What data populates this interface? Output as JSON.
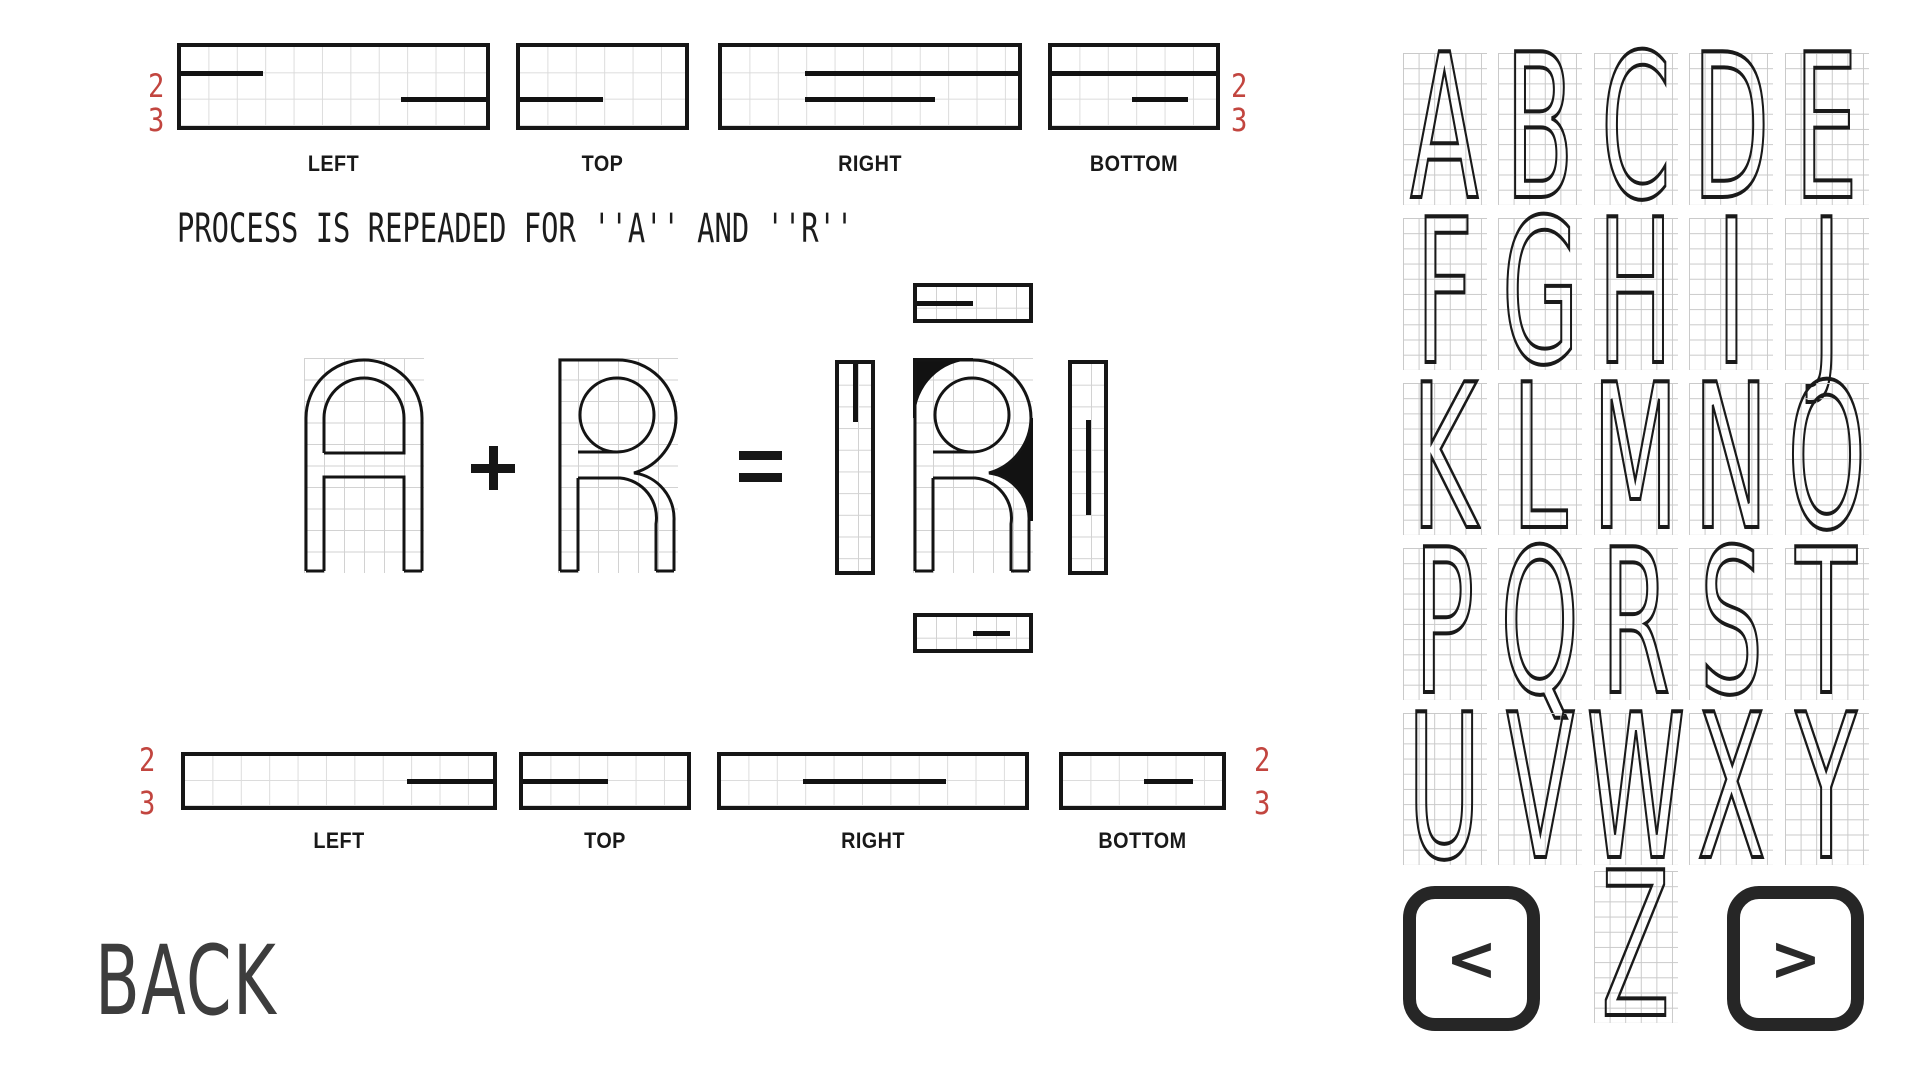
{
  "colors": {
    "ink": "#161616",
    "accent_red": "#c2453f",
    "grid_line": "#d2d2d2",
    "back_text": "#3d3d3d"
  },
  "caption": {
    "text": "PROCESS IS REPEADED FOR ''A'' AND ''R''"
  },
  "back_button": {
    "label": "BACK"
  },
  "equation": {
    "letter_a": "A",
    "letter_r": "R",
    "plus": "+",
    "equals": "=",
    "result_letter": "R"
  },
  "side_view_rows": {
    "top": {
      "id": "top",
      "top": 43,
      "height": 87,
      "rows": 3,
      "label_y": 151,
      "digits": {
        "values": [
          "2",
          "3"
        ],
        "left_x": 148,
        "right_x": 1231,
        "ys": [
          67,
          101
        ]
      },
      "boxes": [
        {
          "label": "LEFT",
          "left": 177,
          "width": 313,
          "segments": [
            {
              "line": 1,
              "from": 0,
              "to": 0.27
            },
            {
              "line": 2,
              "from": 0.72,
              "to": 1
            }
          ]
        },
        {
          "label": "TOP",
          "left": 516,
          "width": 173,
          "segments": [
            {
              "line": 2,
              "from": 0,
              "to": 0.5
            }
          ]
        },
        {
          "label": "RIGHT",
          "left": 718,
          "width": 304,
          "segments": [
            {
              "line": 1,
              "from": 0.28,
              "to": 1
            },
            {
              "line": 2,
              "from": 0.28,
              "to": 0.72
            }
          ]
        },
        {
          "label": "BOTTOM",
          "left": 1048,
          "width": 172,
          "segments": [
            {
              "line": 1,
              "from": 0,
              "to": 1
            },
            {
              "line": 2,
              "from": 0.49,
              "to": 0.83
            }
          ]
        }
      ]
    },
    "bottom": {
      "id": "bottom",
      "top": 752,
      "height": 58,
      "rows": 2,
      "label_y": 828,
      "digits": {
        "values": [
          "2",
          "3"
        ],
        "left_x": 139,
        "right_x": 1254,
        "ys": [
          741,
          784
        ]
      },
      "boxes": [
        {
          "label": "LEFT",
          "left": 181,
          "width": 316,
          "segments": [
            {
              "line": 1,
              "from": 0.72,
              "to": 1
            }
          ]
        },
        {
          "label": "TOP",
          "left": 519,
          "width": 172,
          "segments": [
            {
              "line": 1,
              "from": 0,
              "to": 0.52
            }
          ]
        },
        {
          "label": "RIGHT",
          "left": 717,
          "width": 312,
          "segments": [
            {
              "line": 1,
              "from": 0.27,
              "to": 0.74
            }
          ]
        },
        {
          "label": "BOTTOM",
          "left": 1059,
          "width": 167,
          "segments": [
            {
              "line": 1,
              "from": 0.51,
              "to": 0.82
            }
          ]
        }
      ]
    }
  },
  "result_views": {
    "strips": [
      {
        "name": "top",
        "x": 913,
        "y": 283,
        "w": 120,
        "h": 40,
        "orient": "h",
        "from": 0,
        "to": 0.5
      },
      {
        "name": "left",
        "x": 835,
        "y": 360,
        "w": 40,
        "h": 215,
        "orient": "v",
        "from": 0,
        "to": 0.28
      },
      {
        "name": "right",
        "x": 1068,
        "y": 360,
        "w": 40,
        "h": 215,
        "orient": "v",
        "from": 0.27,
        "to": 0.73
      },
      {
        "name": "bottom",
        "x": 913,
        "y": 613,
        "w": 120,
        "h": 40,
        "orient": "h",
        "from": 0.5,
        "to": 0.83
      }
    ]
  },
  "alphabet": {
    "grid_letters": [
      "A",
      "B",
      "C",
      "D",
      "E",
      "F",
      "G",
      "H",
      "I",
      "J",
      "K",
      "L",
      "M",
      "N",
      "O",
      "P",
      "Q",
      "R",
      "S",
      "T",
      "U",
      "V",
      "W",
      "X",
      "Y"
    ],
    "bottom_letter": "Z",
    "prev": "<",
    "next": ">"
  }
}
